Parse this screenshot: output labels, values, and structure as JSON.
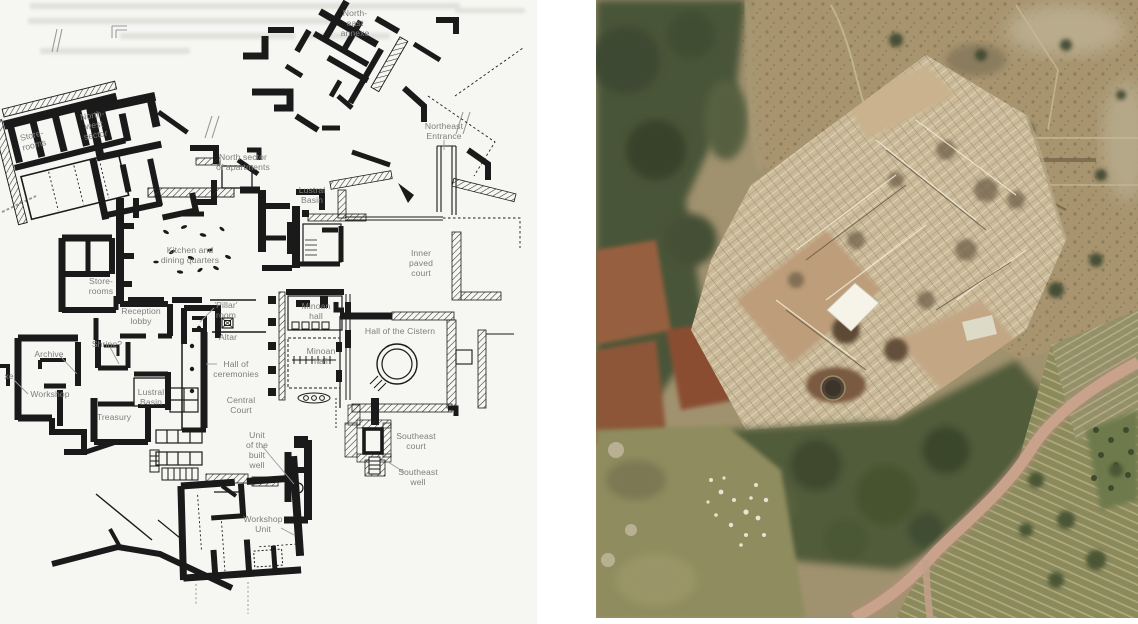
{
  "plan": {
    "paper_color": "#f6f6f3",
    "ink_color": "#1a1a1a",
    "label_color": "#7e7e7e",
    "labels": [
      {
        "id": "northeast-annexe",
        "lines": [
          "North-",
          "east",
          "annexe"
        ],
        "x": 355,
        "y": 8
      },
      {
        "id": "northeast-entrance",
        "lines": [
          "Northeast",
          "Entrance"
        ],
        "x": 444,
        "y": 121
      },
      {
        "id": "storerooms-northwest",
        "lines": [
          "Store-",
          "rooms"
        ],
        "x": 33,
        "y": 130,
        "rotate": -14
      },
      {
        "id": "northwest-sector",
        "lines": [
          "North-",
          "west",
          "sector"
        ],
        "x": 94,
        "y": 110,
        "rotate": -10
      },
      {
        "id": "north-sector-of-apartments",
        "lines": [
          "North sector",
          "of apartments"
        ],
        "x": 243,
        "y": 152
      },
      {
        "id": "lustral-basin-north",
        "lines": [
          "Lustral",
          "Basin"
        ],
        "x": 312,
        "y": 185
      },
      {
        "id": "kitchen-dining-quarters",
        "lines": [
          "Kitchen and",
          "dining quarters"
        ],
        "x": 190,
        "y": 245
      },
      {
        "id": "inner-paved-court",
        "lines": [
          "Inner",
          "paved",
          "court"
        ],
        "x": 421,
        "y": 248
      },
      {
        "id": "storerooms-west",
        "lines": [
          "Store-",
          "rooms"
        ],
        "x": 101,
        "y": 276
      },
      {
        "id": "reception-lobby",
        "lines": [
          "Reception",
          "lobby"
        ],
        "x": 141,
        "y": 306
      },
      {
        "id": "pillar-room",
        "lines": [
          "'Pillar'",
          "room"
        ],
        "x": 226,
        "y": 300
      },
      {
        "id": "altar",
        "lines": [
          "Altar"
        ],
        "x": 228,
        "y": 332
      },
      {
        "id": "minoan-hall-upper",
        "lines": [
          "Minoan",
          "hall"
        ],
        "x": 316,
        "y": 301
      },
      {
        "id": "hall-of-the-cistern",
        "lines": [
          "Hall of the Cistern"
        ],
        "x": 400,
        "y": 326
      },
      {
        "id": "minoan-hall-lower",
        "lines": [
          "Minoan",
          "hall"
        ],
        "x": 321,
        "y": 346
      },
      {
        "id": "shrine",
        "lines": [
          "Shrine?"
        ],
        "x": 107,
        "y": 339
      },
      {
        "id": "archive",
        "lines": [
          "Archive"
        ],
        "x": 49,
        "y": 349
      },
      {
        "id": "annexe-edge-fragment",
        "lines": [
          "xe"
        ],
        "x": 9,
        "y": 371
      },
      {
        "id": "workshop",
        "lines": [
          "Workshop"
        ],
        "x": 50,
        "y": 389
      },
      {
        "id": "lustral-basin-west",
        "lines": [
          "Lustral",
          "Basin"
        ],
        "x": 151,
        "y": 387
      },
      {
        "id": "hall-of-ceremonies",
        "lines": [
          "Hall of",
          "ceremonies"
        ],
        "x": 236,
        "y": 359
      },
      {
        "id": "treasury",
        "lines": [
          "Treasury"
        ],
        "x": 114,
        "y": 412
      },
      {
        "id": "central-court",
        "lines": [
          "Central",
          "Court"
        ],
        "x": 241,
        "y": 395
      },
      {
        "id": "unit-of-the-built-well",
        "lines": [
          "Unit",
          "of the",
          "built",
          "well"
        ],
        "x": 257,
        "y": 430
      },
      {
        "id": "southeast-court",
        "lines": [
          "Southeast",
          "court"
        ],
        "x": 416,
        "y": 431
      },
      {
        "id": "southeast-well",
        "lines": [
          "Southeast",
          "well"
        ],
        "x": 418,
        "y": 467
      },
      {
        "id": "workshop-unit",
        "lines": [
          "Workshop",
          "Unit"
        ],
        "x": 263,
        "y": 514
      }
    ]
  },
  "photo": {
    "subject": "aerial-view-of-excavated-palace-ruins",
    "colors": {
      "vegetation": "#45503a",
      "scrub": "#a8946f",
      "ruins": "#cbbb9a",
      "court": "#bd9d7a",
      "tarp": "#f6f3e8",
      "soil": "#96603f",
      "road": "#c9a28c",
      "field_rows": "#8a8a5d",
      "grass": "#8f8c5f"
    }
  }
}
